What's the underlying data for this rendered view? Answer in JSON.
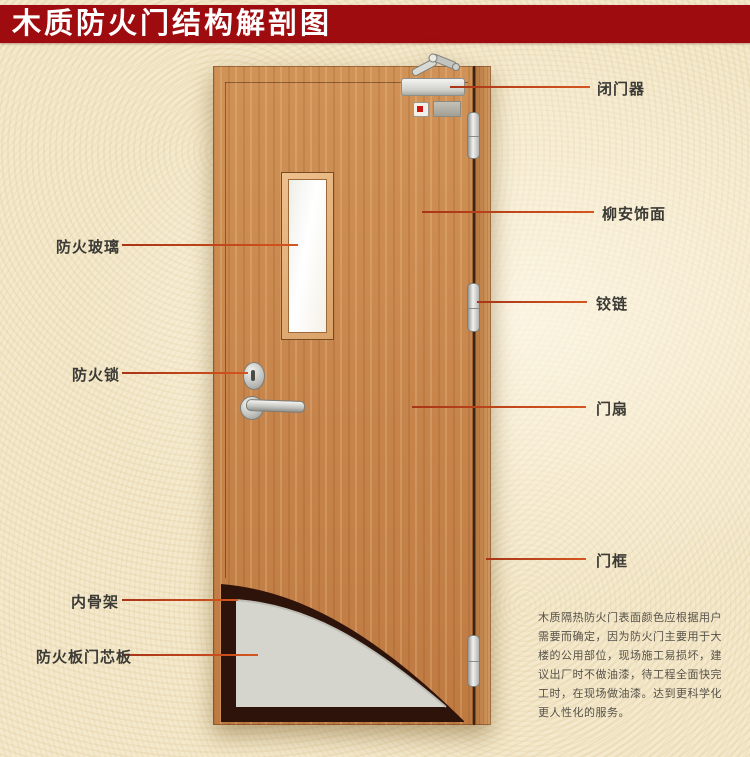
{
  "title": "木质防火门结构解剖图",
  "callouts": {
    "door_closer": "闭门器",
    "lauan_veneer": "柳安饰面",
    "hinge": "铰链",
    "door_leaf": "门扇",
    "door_frame": "门框",
    "fire_glass": "防火玻璃",
    "fire_lock": "防火锁",
    "inner_skeleton": "内骨架",
    "fire_board_core": "防火板门芯板"
  },
  "note": {
    "lines": [
      "木质隔热防火门表面颜色应根据用户",
      "需要而确定，因为防火门主要用于大",
      "楼的公用部位，现场施工易损坏，建",
      "议出厂时不做油漆，待工程全面快完",
      "工时，在现场做油漆。达到更科学化",
      "更人性化的服务。"
    ]
  },
  "colors": {
    "banner_red": "#9e0c10",
    "leader_line": "#c8431f",
    "door_wood": "#c98950",
    "core_gray": "#d5d5cd",
    "skeleton_dark": "#2e130b",
    "background_cream": "#f4e9cc"
  }
}
